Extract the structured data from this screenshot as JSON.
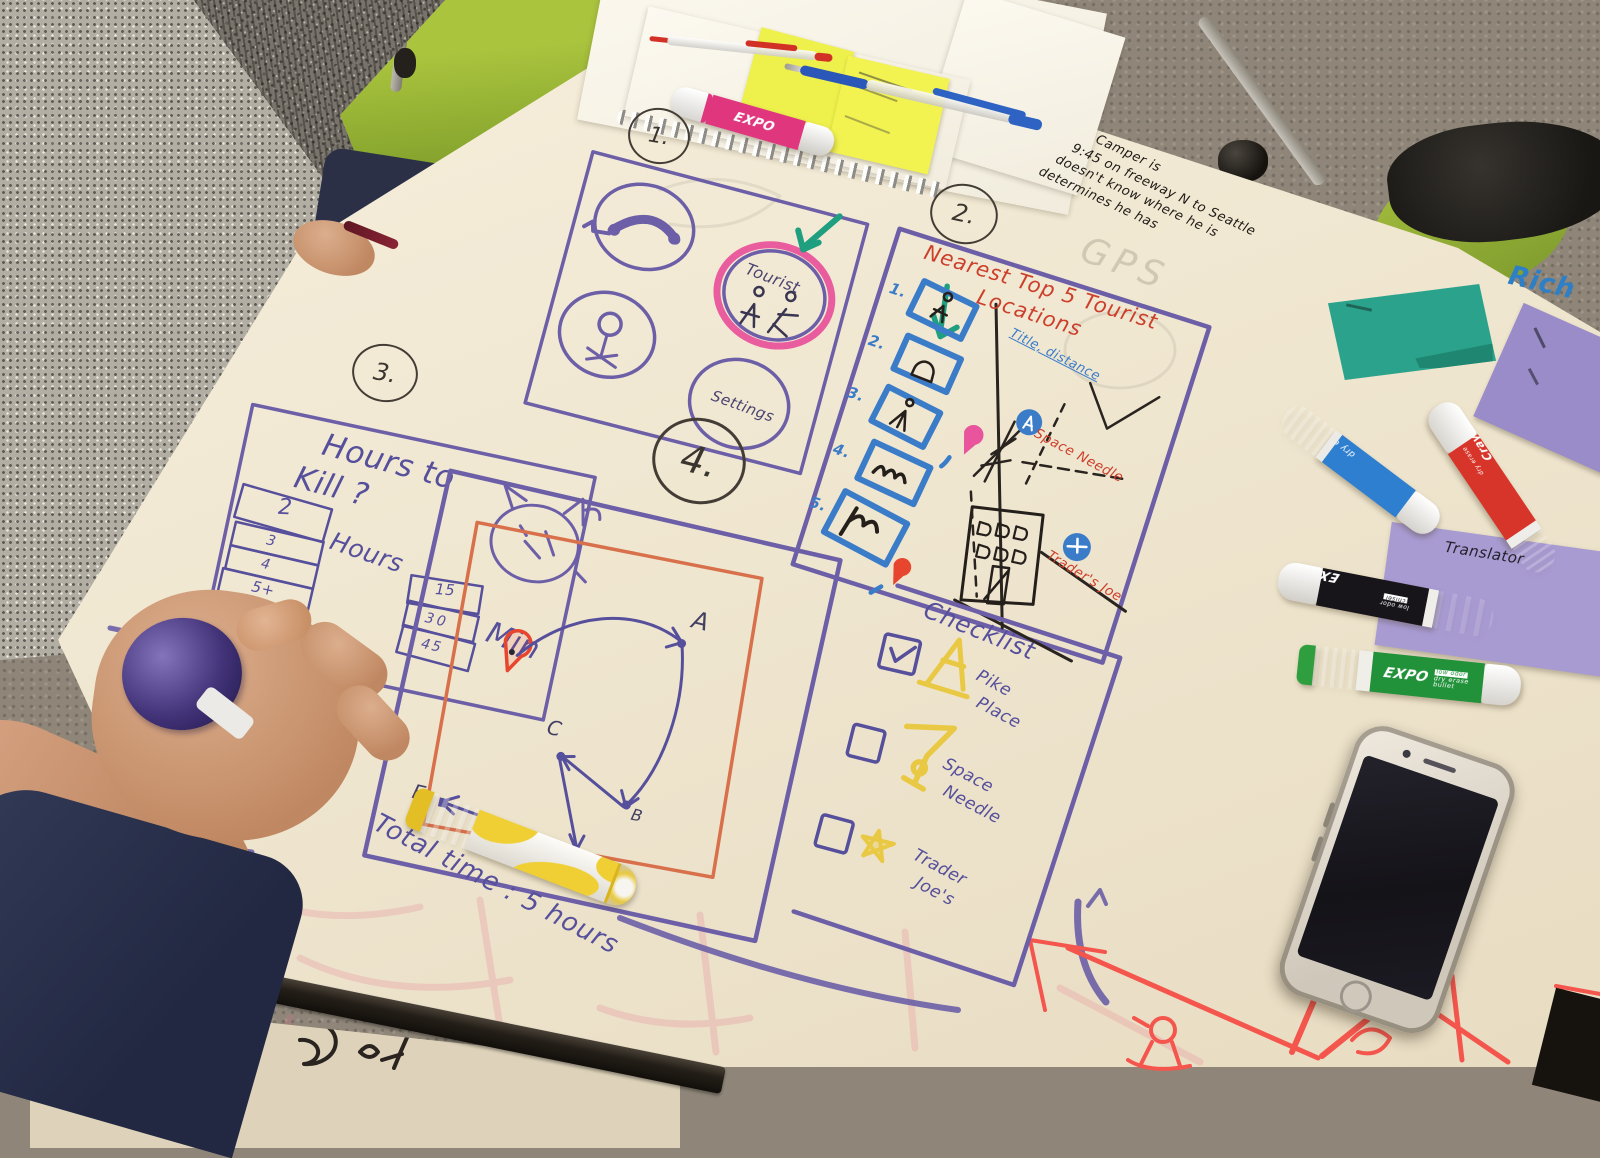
{
  "panels": {
    "sketch1": {
      "number": "1.",
      "tourist_label": "Tourist",
      "settings_label": "Settings"
    },
    "sketch2": {
      "number": "2.",
      "title_line1": "Nearest Top 5 Tourist",
      "title_line2": "Locations",
      "list": [
        "1.",
        "2.",
        "3.",
        "4.",
        "5."
      ],
      "label_title_distance": "Title, distance",
      "label_space_needle": "Space Needle",
      "label_traders_joe": "Trader's Joe"
    },
    "sketch3": {
      "number": "3.",
      "title_line1": "Hours to",
      "title_line2": "Kill ?",
      "hours_values": [
        "2",
        "3",
        "4",
        "5+"
      ],
      "hours_label": "Hours",
      "min_values": [
        "15",
        "30",
        "45"
      ],
      "min_label": "Min"
    },
    "sketch4": {
      "number": "4.",
      "waypoints": [
        "A",
        "B",
        "C",
        "D",
        "E"
      ],
      "total_time": "Total time : 5 hours"
    },
    "checklist": {
      "title": "Checklist",
      "items": [
        {
          "line1": "Pike",
          "line2": "Place",
          "checked": true
        },
        {
          "line1": "Space",
          "line2": "Needle",
          "checked": false
        },
        {
          "line1": "Trader",
          "line2": "Joe's",
          "checked": false
        }
      ]
    }
  },
  "annotations": {
    "note_lines": [
      "Camper is",
      "9:45 on freeway N to Seattle",
      "doesn't know where he is",
      "determines he has"
    ],
    "gps": "GPS",
    "rich": "Rich"
  },
  "sticky_notes": {
    "translator": "Translator"
  },
  "markers": {
    "blue": {
      "label": "dry erase"
    },
    "red": {
      "brand": "Crayola",
      "label": "dry erase"
    },
    "black": {
      "brand": "EXPO",
      "sub": "low odor",
      "tip": "chisel"
    },
    "green": {
      "brand": "EXPO",
      "line": "dry erase",
      "sub": "low odor",
      "tip": "bullet"
    },
    "pink": {
      "brand": "EXPO"
    }
  },
  "colors": {
    "purple": "#564f9c",
    "red_ink": "#cc3f2b",
    "blue_ink": "#3b7cc9",
    "green_ink": "#1f9e80",
    "yellow_ink": "#e9c944",
    "orange_ink": "#d8704b",
    "red_marker": "#f4564d"
  }
}
